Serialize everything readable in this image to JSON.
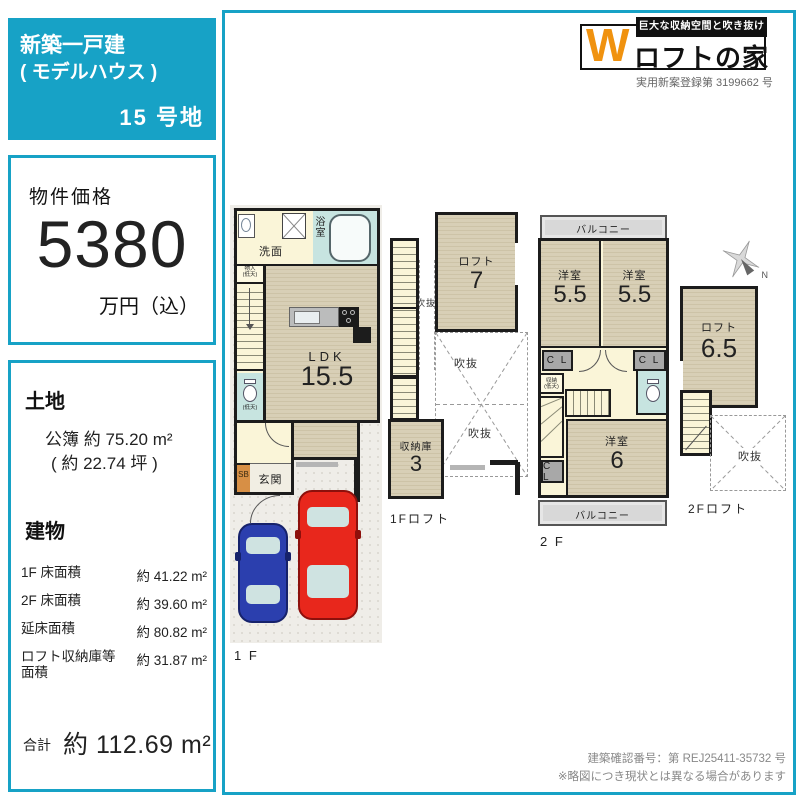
{
  "colors": {
    "accent": "#17a2c6",
    "logo_orange": "#f0920f",
    "tatami": "#d8cfb6",
    "bath_teal": "#c7e4e0",
    "car_red": "#e8271c",
    "car_blue": "#2b3fae"
  },
  "header": {
    "line1": "新築一戸建",
    "line2": "( モデルハウス )",
    "lot": "15 号地"
  },
  "price": {
    "label": "物件価格",
    "amount": "5380",
    "unit": "万円（込）"
  },
  "land": {
    "title": "土地",
    "area": "公簿 約 75.20 m²",
    "tsubo": "( 約 22.74 坪 )"
  },
  "building": {
    "title": "建物",
    "rows": [
      {
        "label": "1F 床面積",
        "value": "約 41.22 m²"
      },
      {
        "label": "2F 床面積",
        "value": "約 39.60 m²"
      },
      {
        "label": "延床面積",
        "value": "約 80.82 m²"
      },
      {
        "label": "ロフト収納庫等面積",
        "value": "約 31.87 m²"
      }
    ],
    "total_label": "合計",
    "total_value": "約 112.69 m²"
  },
  "logo": {
    "tagline": "巨大な収納空間と吹き抜け",
    "w": "W",
    "name": "ロフトの家",
    "registration": "実用新案登録第 3199662 号"
  },
  "plans": {
    "f1": {
      "caption": "1 F",
      "washroom": "洗面",
      "bath": "浴室",
      "closet": "物入",
      "closet_note": "(低天)",
      "toilet_note": "(低天)",
      "ldk": "LDK",
      "ldk_size": "15.5",
      "shoebox": "SB",
      "entrance": "玄関"
    },
    "f1loft": {
      "caption": "1Fロフト",
      "loft": "ロフト",
      "loft_size": "7",
      "void_a": "吹抜",
      "void_b": "吹抜",
      "void_c": "吹抜",
      "storage": "収納庫",
      "storage_size": "3"
    },
    "f2": {
      "caption": "2 F",
      "balcony_top": "バルコニー",
      "balcony_bottom": "バルコニー",
      "bed1": "洋室",
      "bed1_size": "5.5",
      "bed2": "洋室",
      "bed2_size": "5.5",
      "bed3": "洋室",
      "bed3_size": "6",
      "cl1": "C L",
      "cl2": "C L",
      "cl3": "C L",
      "storage": "収納",
      "storage_note": "(低天)"
    },
    "f2loft": {
      "caption": "2Fロフト",
      "loft": "ロフト",
      "loft_size": "6.5",
      "void": "吹抜",
      "north": "N"
    }
  },
  "footer": {
    "line1": "建築確認番号：第 REJ25411-35732 号",
    "line2": "※略図につき現状とは異なる場合があります"
  }
}
